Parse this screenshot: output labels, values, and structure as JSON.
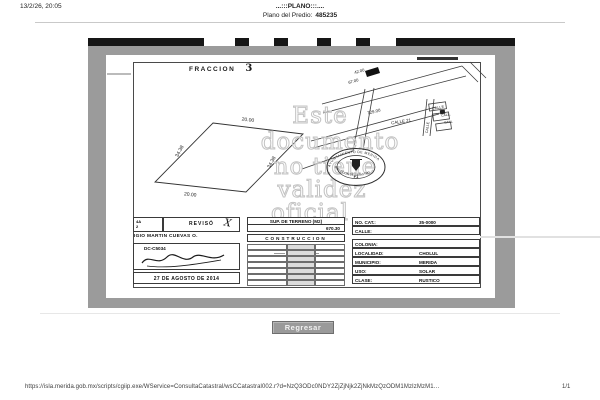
{
  "header": {
    "datetime": "13/2/26, 20:05",
    "title": "...:::PLANO:::....",
    "predio_label": "Plano del Predio:",
    "predio_value": "485235"
  },
  "footer": {
    "url": "https://isla.merida.gob.mx/scripts/cgiip.exe/WService=ConsultaCatastral/wsCCatastral002.r?d=NzQ3ODc0NDY2ZjZjNjk2ZjNkMzQzODM1MzIzMzM1…",
    "page_number": "1/1"
  },
  "button": {
    "label": "Regresar"
  },
  "plan": {
    "fraccion_label": "FRACCION",
    "fraccion_value": "3",
    "lot": {
      "top": "20.00",
      "bottom": "20.00",
      "left": "34.38",
      "right": "34.38"
    },
    "streets": {
      "d42": "42.00",
      "d67": "67.00",
      "d729": "729.00",
      "calle21": "CALLE 21",
      "calle_a": "CALLE",
      "calle_b": "CALL.",
      "calle_c": "CALL",
      "calle_v": "CALLE"
    },
    "watermark": {
      "l1": "Este",
      "l2": "documento",
      "l3": "no tiene",
      "l4": "validez",
      "l5": "oficial"
    },
    "seal": {
      "top_text": "AYUNTAMIENTO DE MERIDA",
      "bottom_text": "DIRECCION DE CATASTRO",
      "center": "F1"
    },
    "table": {
      "left": {
        "cellA_line1": "4A",
        "cellA_line2": "2",
        "reviso": "REVISÓ",
        "check": "X",
        "name": "IGIO MARTIN CUEVAS O.",
        "code": "DC-C5034",
        "date": "27 DE AGOSTO DE 2014"
      },
      "middle": {
        "sup_header": "SUP. DE TERRENO (M2)",
        "sup_value": "670.30",
        "construccion": "CONSTRUCCION"
      },
      "right": {
        "rows": [
          {
            "label": "NO. CAT.:",
            "value": "35-0000"
          },
          {
            "label": "CALLE:",
            "value": ""
          },
          {
            "label": "COLONIA:",
            "value": ""
          },
          {
            "label": "LOCALIDAD:",
            "value": "CHOLUL"
          },
          {
            "label": "MUNICIPIO:",
            "value": "MERIDA"
          },
          {
            "label": "USO:",
            "value": "SOLAR"
          },
          {
            "label": "CLASE:",
            "value": "RUSTICO"
          }
        ]
      }
    }
  },
  "colors": {
    "matte_gray": "#9b9b9b",
    "scan_bar": "#161616",
    "watermark_gray": "#c3c3c3",
    "button_gray": "#9a9a9a"
  }
}
